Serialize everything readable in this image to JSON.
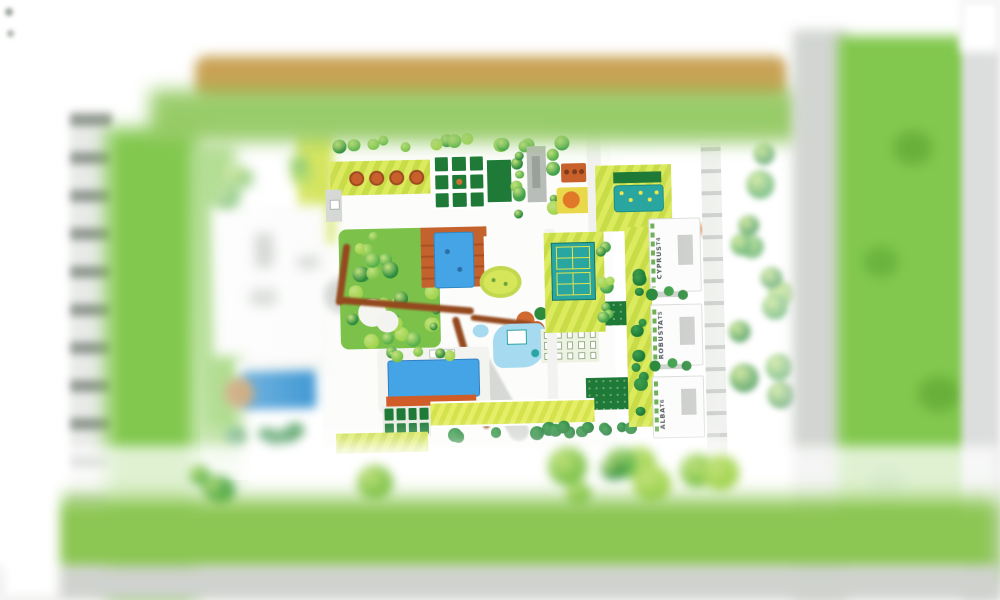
{
  "plan": {
    "towers": [
      {
        "name": "CYPRUS",
        "tier": "T4"
      },
      {
        "name": "ROBUSTA",
        "tier": "T5"
      },
      {
        "name": "ALBA",
        "tier": "T6"
      }
    ]
  },
  "colors": {
    "page_bg": "#ffffff",
    "lawn_stripe_light": "#dcea5e",
    "lawn_stripe_dark": "#c8dc48",
    "hedge_dark_green": "#1e7a36",
    "tree_green": "#3fa04a",
    "tree_light": "#7cc24a",
    "field_green": "#82c84e",
    "pool_blue": "#45a4e6",
    "pool_deep": "#2f8fd0",
    "teal_pool": "#2aa6a0",
    "water_light": "#a5daf0",
    "terracotta": "#c4622e",
    "path_brown": "#94491e",
    "road_tan": "#c9a255",
    "road_gray": "#d2d5d1",
    "building_white": "#fbfcfb",
    "building_gray": "#b9bdb9",
    "label_text": "#51585c"
  }
}
